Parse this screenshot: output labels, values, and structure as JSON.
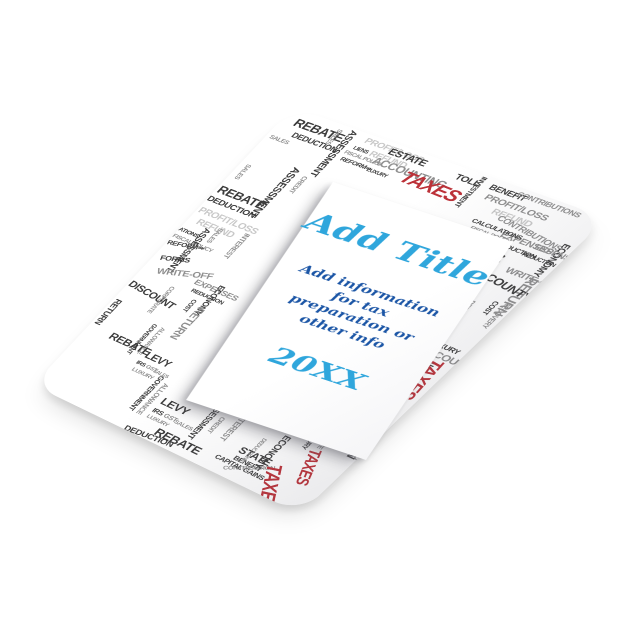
{
  "panel": {
    "title": "Add Title",
    "info_lines": [
      "Add information",
      "for tax",
      "preparation or",
      "other info"
    ],
    "year": "20XX",
    "title_color": "#2FA6DC",
    "info_color": "#1C56A6",
    "year_color": "#2FA6DC"
  },
  "border": {
    "colors": {
      "dark": "#3C3C3C",
      "mid": "#8F8F8F",
      "light": "#C8C8C8",
      "red": "#BC3138"
    },
    "words": [
      {
        "t": "REBATE",
        "x": 14,
        "y": 8,
        "s": 14,
        "r": 0,
        "c": "d"
      },
      {
        "t": "DEDUCTION",
        "x": 22,
        "y": 26,
        "s": 9,
        "r": 0,
        "c": "d"
      },
      {
        "t": "SALES",
        "x": 4,
        "y": 38,
        "s": 7,
        "r": 0,
        "c": "m"
      },
      {
        "t": "PROFIT/LOSS",
        "x": 88,
        "y": 4,
        "s": 10,
        "r": 0,
        "c": "l"
      },
      {
        "t": "REFUND",
        "x": 102,
        "y": 16,
        "s": 10,
        "r": 0,
        "c": "l"
      },
      {
        "t": "LIENS",
        "x": 84,
        "y": 18,
        "s": 6,
        "r": 0,
        "c": "d"
      },
      {
        "t": "FISCAL POLICY",
        "x": 80,
        "y": 26,
        "s": 6,
        "r": 0,
        "c": "m"
      },
      {
        "t": "REFORM⇒",
        "x": 82,
        "y": 34,
        "s": 7,
        "r": 0,
        "c": "d"
      },
      {
        "t": "ASSESSMENT",
        "x": 76,
        "y": 2,
        "s": 10,
        "r": 90,
        "c": "d"
      },
      {
        "t": "SALES",
        "x": 62,
        "y": 6,
        "s": 7,
        "r": 90,
        "c": "m"
      },
      {
        "t": "ESTATE",
        "x": 116,
        "y": 6,
        "s": 11,
        "r": 0,
        "c": "d"
      },
      {
        "t": "ACCOUNTING",
        "x": 110,
        "y": 20,
        "s": 12,
        "r": 0,
        "c": "m"
      },
      {
        "t": "TOLL",
        "x": 188,
        "y": 8,
        "s": 10,
        "r": 0,
        "c": "d"
      },
      {
        "t": "LUXURY",
        "x": 112,
        "y": 36,
        "s": 6,
        "r": 0,
        "c": "d"
      },
      {
        "t": "TAXES",
        "x": 146,
        "y": 22,
        "s": 20,
        "r": 2,
        "c": "r"
      },
      {
        "t": "BENEFIT",
        "x": 222,
        "y": 6,
        "s": 9,
        "r": 0,
        "c": "d"
      },
      {
        "t": "PROFIT/LOSS",
        "x": 226,
        "y": 18,
        "s": 10,
        "r": 0,
        "c": "m"
      },
      {
        "t": "REFUND",
        "x": 242,
        "y": 30,
        "s": 10,
        "r": 0,
        "c": "l"
      },
      {
        "t": "INVESTMENT",
        "x": 214,
        "y": 2,
        "s": 7,
        "r": 90,
        "c": "d"
      },
      {
        "t": "CONTRIBUTIONS",
        "x": 248,
        "y": 4,
        "s": 8,
        "r": 0,
        "c": "m"
      },
      {
        "t": "CONTRIBUTIONS",
        "x": 252,
        "y": 34,
        "s": 9,
        "r": 8,
        "c": "m"
      },
      {
        "t": "EXPENSES",
        "x": 266,
        "y": 50,
        "s": 10,
        "r": 0,
        "c": "m"
      },
      {
        "t": "REDUCTION",
        "x": 270,
        "y": 62,
        "s": 7,
        "r": 0,
        "c": "d"
      },
      {
        "t": "ECONOMY",
        "x": 326,
        "y": 40,
        "s": 9,
        "r": 90,
        "c": "d"
      },
      {
        "t": "CALCULATIONS",
        "x": 234,
        "y": 48,
        "s": 7,
        "r": 0,
        "c": "d"
      },
      {
        "t": "FISCAL POLICY",
        "x": 238,
        "y": 57,
        "s": 6,
        "r": 0,
        "c": "m"
      },
      {
        "t": "REFORM⇒",
        "x": 240,
        "y": 65,
        "s": 7,
        "r": 0,
        "c": "d"
      },
      {
        "t": "FORMS",
        "x": 250,
        "y": 78,
        "s": 9,
        "r": -20,
        "c": "d"
      },
      {
        "t": "ACCOUNTING",
        "x": 286,
        "y": 72,
        "s": 11,
        "r": 90,
        "c": "d"
      },
      {
        "t": "WRITE-OFF",
        "x": 296,
        "y": 84,
        "s": 10,
        "r": 0,
        "c": "m"
      },
      {
        "t": "REDUCTION",
        "x": 296,
        "y": 64,
        "s": 6,
        "r": 0,
        "c": "d"
      },
      {
        "t": "EXPENSES",
        "x": 300,
        "y": 50,
        "s": 9,
        "r": 0,
        "c": "m"
      },
      {
        "t": "RETURN",
        "x": 330,
        "y": 86,
        "s": 13,
        "r": 90,
        "c": "m"
      },
      {
        "t": "COUNTY",
        "x": 288,
        "y": 96,
        "s": 12,
        "r": 8,
        "c": "d"
      },
      {
        "t": "COST",
        "x": 316,
        "y": 124,
        "s": 7,
        "r": 90,
        "c": "d"
      },
      {
        "t": "RECOVERY",
        "x": 326,
        "y": 120,
        "s": 7,
        "r": 90,
        "c": "m"
      },
      {
        "t": "DEDUCTIONS",
        "x": 298,
        "y": 132,
        "s": 7,
        "r": 90,
        "c": "m"
      },
      {
        "t": "LUXURY",
        "x": 294,
        "y": 188,
        "s": 8,
        "r": 0,
        "c": "d"
      },
      {
        "t": "ACCOUNT",
        "x": 292,
        "y": 198,
        "s": 11,
        "r": 0,
        "c": "m"
      },
      {
        "t": "STATE",
        "x": 284,
        "y": 212,
        "s": 11,
        "r": 0,
        "c": "d"
      },
      {
        "t": "BENEFIT",
        "x": 282,
        "y": 226,
        "s": 8,
        "r": 0,
        "c": "d"
      },
      {
        "t": "ECONOMY",
        "x": 304,
        "y": 222,
        "s": 11,
        "r": 90,
        "c": "d"
      },
      {
        "t": "TAXES",
        "x": 324,
        "y": 206,
        "s": 18,
        "r": 86,
        "c": "r"
      },
      {
        "t": "GAINS",
        "x": 312,
        "y": 272,
        "s": 7,
        "r": 90,
        "c": "m"
      },
      {
        "t": "TIONS",
        "x": 320,
        "y": 282,
        "s": 7,
        "r": 90,
        "c": "d"
      },
      {
        "t": "RETURN",
        "x": 330,
        "y": 300,
        "s": 12,
        "r": 90,
        "c": "d"
      },
      {
        "t": "WRITE-OFF",
        "x": 282,
        "y": 304,
        "s": 9,
        "r": -25,
        "c": "m"
      },
      {
        "t": "CORPORATE",
        "x": 296,
        "y": 312,
        "s": 7,
        "r": 90,
        "c": "m"
      },
      {
        "t": "LUXURY",
        "x": 284,
        "y": 334,
        "s": 7,
        "r": 90,
        "c": "d"
      },
      {
        "t": "ACCOUNT",
        "x": 306,
        "y": 336,
        "s": 10,
        "r": 8,
        "c": "m"
      },
      {
        "t": "TAXES",
        "x": 298,
        "y": 352,
        "s": 16,
        "r": 70,
        "c": "r"
      },
      {
        "t": "LEVY",
        "x": 128,
        "y": 372,
        "s": 13,
        "r": 0,
        "c": "d"
      },
      {
        "t": "IRS",
        "x": 128,
        "y": 390,
        "s": 8,
        "r": 0,
        "c": "d"
      },
      {
        "t": "GST",
        "x": 142,
        "y": 390,
        "s": 8,
        "r": 0,
        "c": "m"
      },
      {
        "t": "SALES",
        "x": 156,
        "y": 392,
        "s": 7,
        "r": 0,
        "c": "m"
      },
      {
        "t": "LUXURY",
        "x": 128,
        "y": 400,
        "s": 7,
        "r": 0,
        "c": "m"
      },
      {
        "t": "GOVERNMENT",
        "x": 112,
        "y": 352,
        "s": 8,
        "r": 90,
        "c": "d"
      },
      {
        "t": "ALLOWANCE",
        "x": 122,
        "y": 358,
        "s": 8,
        "r": 90,
        "c": "m"
      },
      {
        "t": "ASSESSMENT",
        "x": 186,
        "y": 348,
        "s": 9,
        "r": 90,
        "c": "d"
      },
      {
        "t": "CREDIT",
        "x": 196,
        "y": 366,
        "s": 7,
        "r": 90,
        "c": "m"
      },
      {
        "t": "REBATE",
        "x": 148,
        "y": 408,
        "s": 14,
        "r": 0,
        "c": "d"
      },
      {
        "t": "DEDUCTION",
        "x": 118,
        "y": 424,
        "s": 10,
        "r": -6,
        "c": "d"
      },
      {
        "t": "INTEREST",
        "x": 214,
        "y": 350,
        "s": 9,
        "r": 90,
        "c": "m"
      },
      {
        "t": "CAPITAL GAINS",
        "x": 218,
        "y": 408,
        "s": 8,
        "r": 0,
        "c": "d"
      },
      {
        "t": "STATE",
        "x": 232,
        "y": 386,
        "s": 12,
        "r": 0,
        "c": "d"
      },
      {
        "t": "BENEFIT",
        "x": 234,
        "y": 400,
        "s": 8,
        "r": 0,
        "c": "d"
      },
      {
        "t": "CONTRIBUTION",
        "x": 232,
        "y": 418,
        "s": 7,
        "r": -32,
        "c": "m"
      },
      {
        "t": "ECONOMY",
        "x": 264,
        "y": 354,
        "s": 10,
        "r": 90,
        "c": "d"
      },
      {
        "t": "DEDUCTIONS",
        "x": 246,
        "y": 368,
        "s": 6,
        "r": 90,
        "c": "m"
      },
      {
        "t": "TAXES",
        "x": 280,
        "y": 386,
        "s": 20,
        "r": 62,
        "c": "r"
      },
      {
        "t": "ASSESSMENT",
        "x": 58,
        "y": 64,
        "s": 11,
        "r": 90,
        "c": "d"
      },
      {
        "t": "CREDIT",
        "x": 70,
        "y": 70,
        "s": 7,
        "r": 90,
        "c": "m"
      },
      {
        "t": "SALES",
        "x": 12,
        "y": 80,
        "s": 7,
        "r": 90,
        "c": "m"
      },
      {
        "t": "REBATE",
        "x": 2,
        "y": 112,
        "s": 14,
        "r": 0,
        "c": "d"
      },
      {
        "t": "DEDUCTION",
        "x": 0,
        "y": 130,
        "s": 10,
        "r": 0,
        "c": "d"
      },
      {
        "t": "PROFIT/LOSS",
        "x": 2,
        "y": 146,
        "s": 11,
        "r": 0,
        "c": "l"
      },
      {
        "t": "REFUND",
        "x": 10,
        "y": 160,
        "s": 11,
        "r": 0,
        "c": "l"
      },
      {
        "t": "ATIONS",
        "x": 0,
        "y": 178,
        "s": 7,
        "r": 0,
        "c": "d"
      },
      {
        "t": "FISCAL POLICY",
        "x": 0,
        "y": 188,
        "s": 7,
        "r": 0,
        "c": "m"
      },
      {
        "t": "REFORM⇒",
        "x": 0,
        "y": 198,
        "s": 8,
        "r": -14,
        "c": "d"
      },
      {
        "t": "ASSESSMENT",
        "x": 30,
        "y": 168,
        "s": 10,
        "r": 90,
        "c": "d"
      },
      {
        "t": "SALES",
        "x": 40,
        "y": 162,
        "s": 7,
        "r": 90,
        "c": "m"
      },
      {
        "t": "INTEREST",
        "x": 68,
        "y": 156,
        "s": 8,
        "r": 90,
        "c": "m"
      },
      {
        "t": "EXPENSES",
        "x": 58,
        "y": 228,
        "s": 10,
        "r": 0,
        "c": "m"
      },
      {
        "t": "REDUCTION",
        "x": 62,
        "y": 240,
        "s": 7,
        "r": 0,
        "c": "d"
      },
      {
        "t": "ECONOMY",
        "x": 90,
        "y": 224,
        "s": 9,
        "r": 90,
        "c": "d"
      },
      {
        "t": "COST",
        "x": 76,
        "y": 252,
        "s": 7,
        "r": 90,
        "c": "d"
      },
      {
        "t": "RETURN",
        "x": 92,
        "y": 258,
        "s": 12,
        "r": 90,
        "c": "m"
      },
      {
        "t": "FORMS",
        "x": 6,
        "y": 218,
        "s": 9,
        "r": -20,
        "c": "d"
      },
      {
        "t": "WRITE-OFF",
        "x": 14,
        "y": 234,
        "s": 11,
        "r": -20,
        "c": "m"
      },
      {
        "t": "DISCOUNT",
        "x": 2,
        "y": 258,
        "s": 12,
        "r": 6,
        "c": "d"
      },
      {
        "t": "CORPORATE",
        "x": 46,
        "y": 248,
        "s": 7,
        "r": 90,
        "c": "m"
      },
      {
        "t": "RETURN",
        "x": 10,
        "y": 288,
        "s": 10,
        "r": 90,
        "c": "d"
      },
      {
        "t": "GOVERNMENT",
        "x": 62,
        "y": 298,
        "s": 7,
        "r": 90,
        "c": "d"
      },
      {
        "t": "ALLOWANCE",
        "x": 72,
        "y": 298,
        "s": 7,
        "r": 90,
        "c": "m"
      },
      {
        "t": "LEVY",
        "x": 76,
        "y": 330,
        "s": 12,
        "r": 0,
        "c": "d"
      },
      {
        "t": "IRS",
        "x": 74,
        "y": 346,
        "s": 7,
        "r": 0,
        "c": "d"
      },
      {
        "t": "GST",
        "x": 86,
        "y": 346,
        "s": 7,
        "r": 0,
        "c": "m"
      },
      {
        "t": "SALES",
        "x": 96,
        "y": 348,
        "s": 6,
        "r": 0,
        "c": "m"
      },
      {
        "t": "LUXURY",
        "x": 76,
        "y": 356,
        "s": 7,
        "r": 0,
        "c": "m"
      },
      {
        "t": "REBATE",
        "x": 28,
        "y": 326,
        "s": 13,
        "r": 0,
        "c": "d"
      }
    ]
  }
}
